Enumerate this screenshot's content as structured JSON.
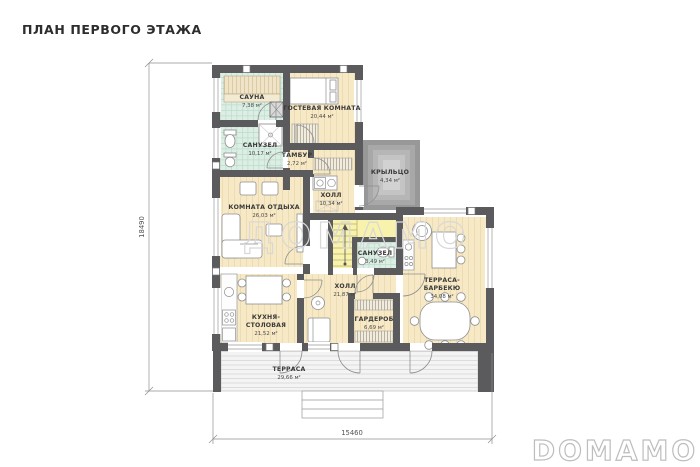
{
  "title": "ПЛАН ПЕРВОГО ЭТАЖА",
  "watermark_text": "ДОМАМО",
  "brand_logo": "DOMAMO",
  "dimensions": {
    "height_total": "18490",
    "width_total": "15460"
  },
  "rooms": {
    "sauna": {
      "name": "САУНА",
      "area": "7,38 м²"
    },
    "guest_room": {
      "name": "ГОСТЕВАЯ КОМНАТА",
      "area": "20,44 м²"
    },
    "bathroom_large": {
      "name": "САНУЗЕЛ",
      "area": "10,17 м²"
    },
    "vestibule": {
      "name": "ТАМБУР",
      "area": "2,72 м²"
    },
    "porch": {
      "name": "КРЫЛЬЦО",
      "area": "4,34 м²"
    },
    "lounge": {
      "name": "КОМНАТА ОТДЫХА",
      "area": "26,03 м²"
    },
    "hall_upper": {
      "name": "ХОЛЛ",
      "area": "10,34 м²"
    },
    "bathroom_small": {
      "name": "САНУЗЕЛ",
      "area": "3,49 м²"
    },
    "terrace_bbq": {
      "name_line1": "ТЕРРАСА-",
      "name_line2": "БАРБЕКЮ",
      "area": "34,08 м²"
    },
    "hall_lower": {
      "name": "ХОЛЛ",
      "area": "21,87 м²"
    },
    "kitchen_dining": {
      "name_line1": "КУХНЯ-",
      "name_line2": "СТОЛОВАЯ",
      "area": "21,52 м²"
    },
    "wardrobe": {
      "name": "ГАРДЕРОБ",
      "area": "6,69 м²"
    },
    "terrace": {
      "name": "ТЕРРАСА",
      "area": "29,66 м²"
    }
  },
  "colors": {
    "wall": "#5b5b5d",
    "wood_floor": "#f7e9c6",
    "tile_floor": "#ddeee5",
    "stairs_floor": "#f8f2ad",
    "porch_grey": "#a8a8a8",
    "label_text": "#3a3a3a",
    "watermark_grey": "#d8d8d8"
  }
}
